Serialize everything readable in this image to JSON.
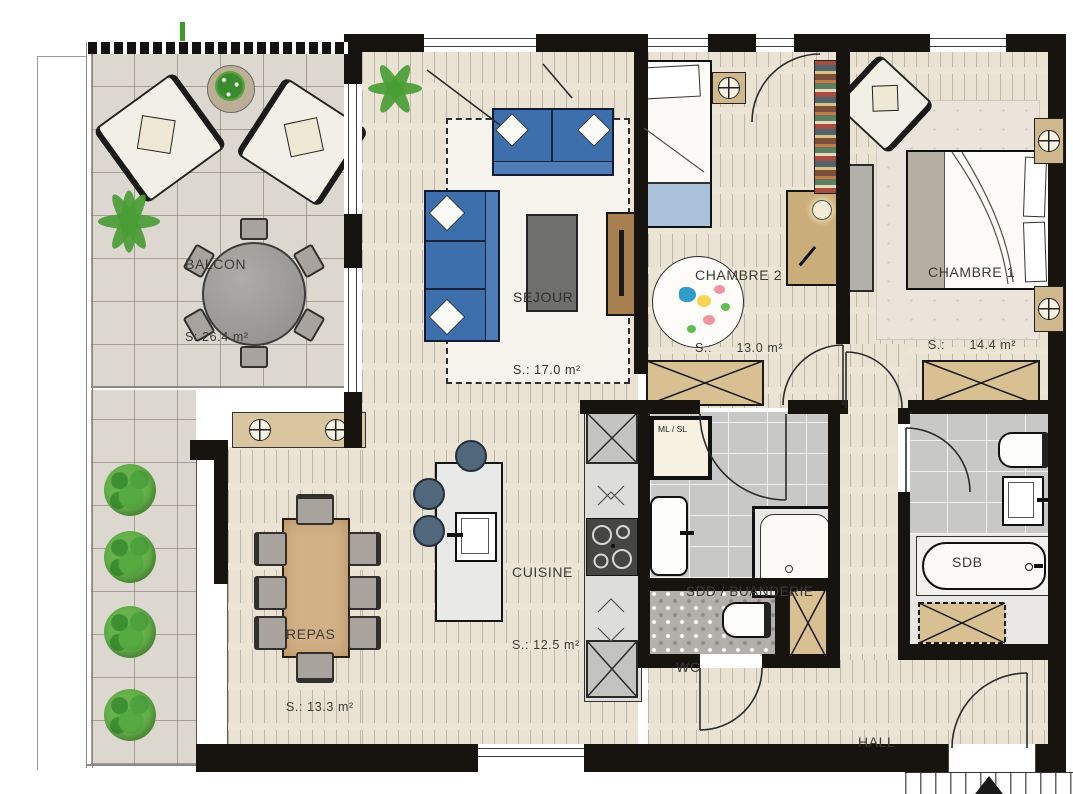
{
  "rooms": {
    "balcon": {
      "name": "BALCON",
      "area": "S: 26.4 m²"
    },
    "sejour": {
      "name": "SEJOUR",
      "area": "S.: 17.0 m²"
    },
    "chambre2": {
      "name": "CHAMBRE 2",
      "area": "S.:      13.0 m²"
    },
    "chambre1": {
      "name": "CHAMBRE 1",
      "area": "S.:      14.4 m²"
    },
    "cuisine": {
      "name": "CUISINE",
      "area": "S.: 12.5 m²"
    },
    "repas": {
      "name": "REPAS",
      "area": "S.: 13.3 m²"
    },
    "sdd": {
      "name": "SDD / BUANDERIE"
    },
    "wc": {
      "name": "WC"
    },
    "sdb": {
      "name": "SDB"
    },
    "hall": {
      "name": "HALL"
    }
  },
  "appliances": {
    "washer_dryer_label": "ML / SL"
  },
  "symbols": {
    "ceiling_light": "circle-with-cross",
    "door_swing": "quarter-circle-arc",
    "stairs_direction": "up-triangle",
    "wardrobe": "rectangle-with-x-cross"
  },
  "colors": {
    "wall": "#17130f",
    "wood_floor": "#eae3d3",
    "balcony_tile": "#dcd8d0",
    "bath_tile": "#c8c8c6",
    "sofa_blue": "#3e6fad",
    "wood_furniture": "#d2b187",
    "wardrobe_tan": "#d8c092",
    "plant_green": "#4a9c35",
    "blanket_blue": "#a9c2da"
  }
}
